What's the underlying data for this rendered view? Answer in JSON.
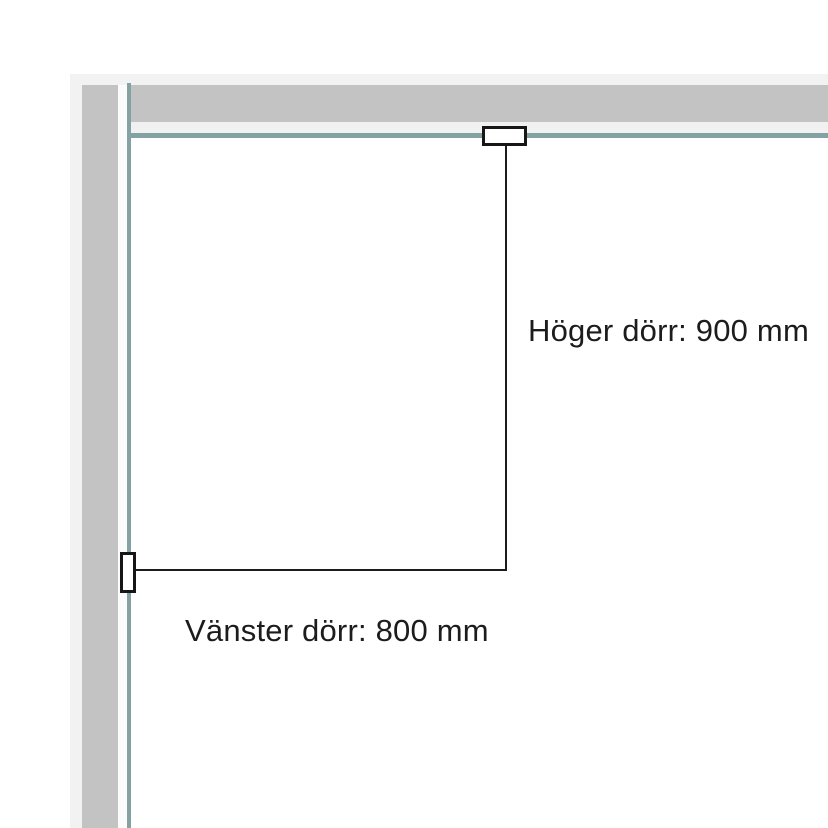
{
  "diagram": {
    "type": "floor-plan-door-dimensions",
    "labels": {
      "right_door": "Höger dörr: 900 mm",
      "left_door": "Vänster dörr: 800 mm"
    },
    "dimensions": {
      "right_door_mm": 900,
      "left_door_mm": 800
    }
  },
  "colors": {
    "background": "#ffffff",
    "outer_band": "#f2f2f2",
    "wall_gray": "#c3c3c3",
    "inner_gap": "#f1f1f1",
    "inner_gap_light": "#fbfbfb",
    "wall_edge_teal": "#84a2a3",
    "dimension_line": "#1c1c1c",
    "label_text": "#1c1c1c",
    "marker_fill": "#ffffff",
    "marker_border": "#161616"
  }
}
